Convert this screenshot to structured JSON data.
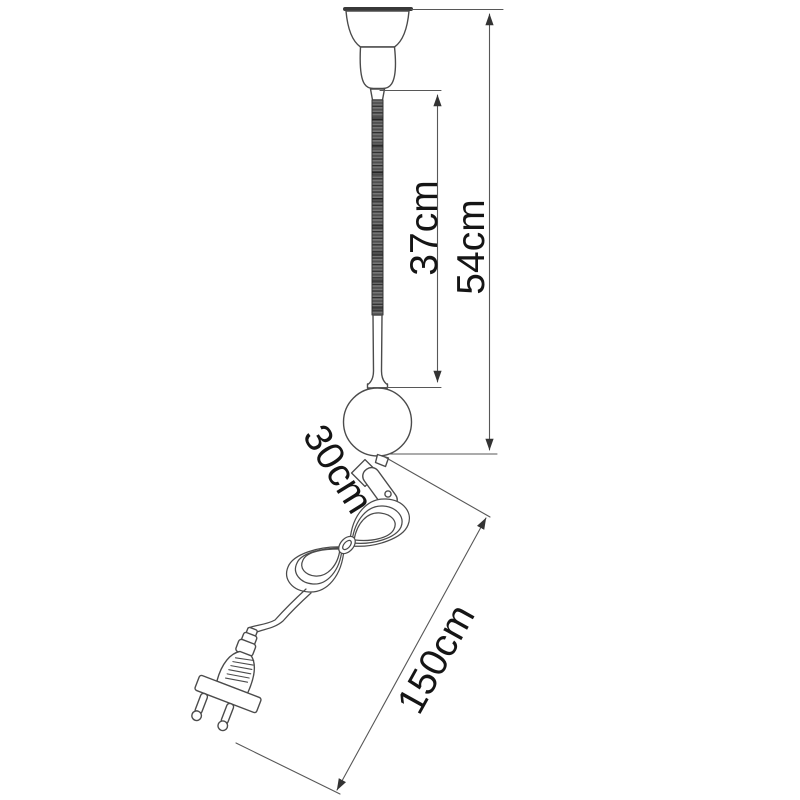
{
  "colors": {
    "line": "#4b4b4b",
    "dim_line": "#575757",
    "text": "#151515",
    "background": "#ffffff",
    "tube_fill": "#6e6e6e"
  },
  "dimensions": {
    "flex_tube": {
      "label": "37cm"
    },
    "total_height": {
      "label": "54cm"
    },
    "shade_section": {
      "label": "30cm"
    },
    "cable": {
      "label": "150cm"
    }
  }
}
